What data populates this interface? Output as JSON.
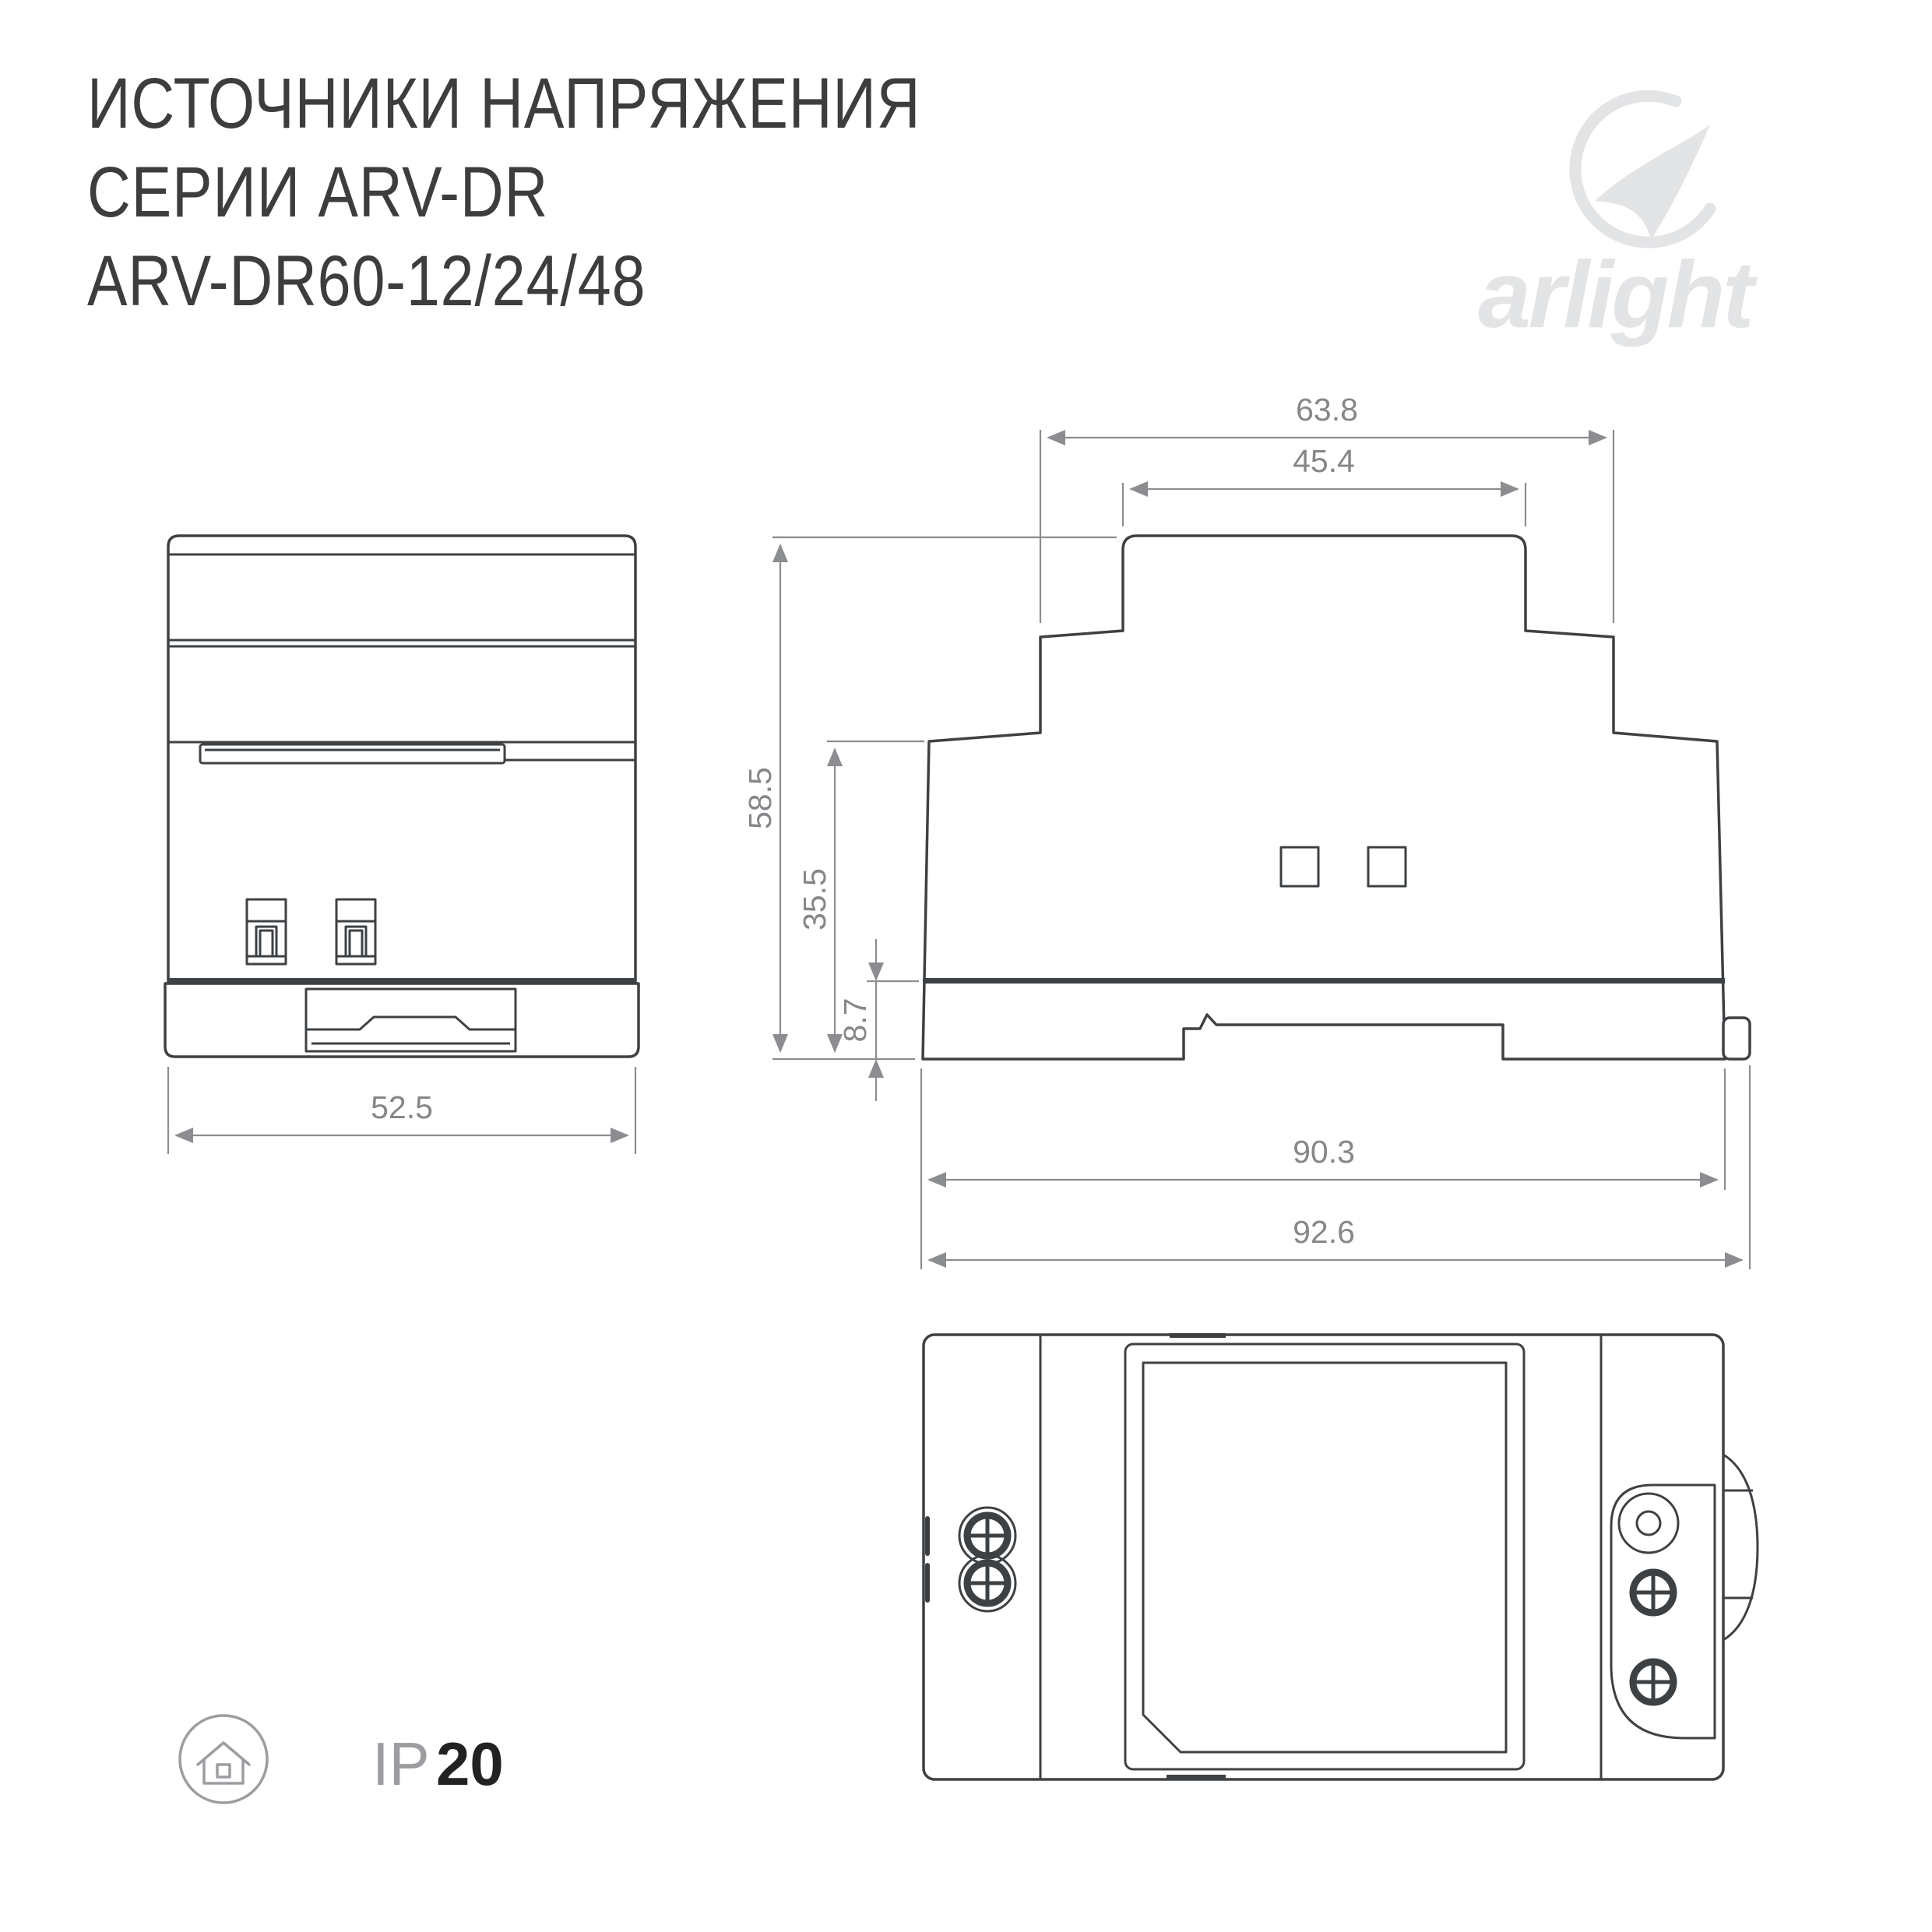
{
  "header": {
    "title_line1": "ИСТОЧНИКИ НАПРЯЖЕНИЯ",
    "title_line2": "СЕРИИ ARV-DR",
    "title_line3": "ARV-DR60-12/24/48"
  },
  "logo": {
    "brand": "arlight"
  },
  "views": {
    "front": {
      "width_mm": "52.5"
    },
    "side": {
      "top_outer_mm": "63.8",
      "top_inner_mm": "45.4",
      "height_total_mm": "58.5",
      "height_body_mm": "35.5",
      "rail_offset_mm": "8.7",
      "body_width_mm": "90.3",
      "total_width_mm": "92.6"
    }
  },
  "badge": {
    "prefix": "IP",
    "rating": "20"
  },
  "colors": {
    "drawing_line": "#3e4144",
    "dimension": "#8b8d90",
    "logo": "#e3e4e6",
    "title": "#3d3d3d",
    "badge_gray": "#9b9da0",
    "badge_dark": "#222222"
  }
}
